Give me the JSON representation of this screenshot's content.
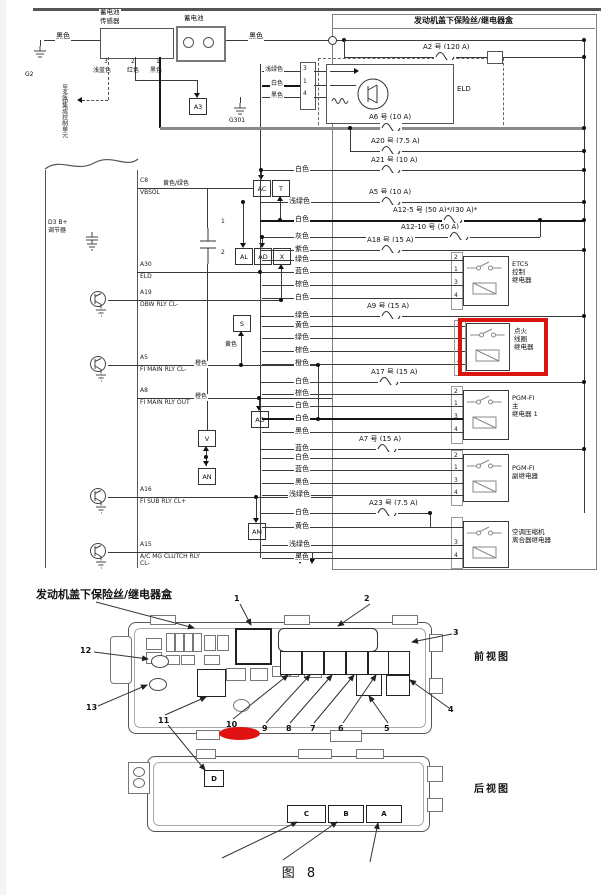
{
  "caption": "图  8",
  "schematic": {
    "box_title": "发动机盖下保险丝/继电器盒",
    "battery_sensor": [
      "蓄电池",
      "传感器"
    ],
    "battery_label": "蓄电池",
    "eld_label": "ELD",
    "regulator": [
      "D3 B+",
      "调节器"
    ],
    "note": "至多路集成控制单元",
    "g2": "G2",
    "g301": "G301",
    "sensor_pins": [
      "3",
      "2",
      "1"
    ],
    "eld_pins": [
      "3",
      "1",
      "4"
    ],
    "cap_pins": [
      "1",
      "2"
    ],
    "connectors": [
      "A3",
      "AC",
      "T",
      "AL",
      "AD",
      "X",
      "S",
      "AO",
      "V",
      "AN",
      "AM"
    ],
    "fuses": {
      "a2": "A2 号 (120 A)",
      "a6": "A6 号 (10 A)",
      "a20": "A20 号 (7.5 A)",
      "a21": "A21 号 (10 A)",
      "a5": "A5 号 (10 A)",
      "a12_5": "A12-5 号 (50 A)*/(30 A)*",
      "a12_10": "A12-10 号 (50 A)",
      "a18": "A18 号 (15 A)",
      "a9": "A9 号 (15 A)",
      "a17": "A17 号 (15 A)",
      "a7": "A7 号 (15 A)",
      "a23": "A23 号 (7.5 A)"
    },
    "relays": {
      "etcs": [
        "ETCS",
        "控制",
        "继电器"
      ],
      "ignition_coil": [
        "点火",
        "线圈",
        "继电器"
      ],
      "pgm_main": [
        "PGM-FI",
        "主",
        "继电器 1"
      ],
      "pgm_sub": [
        "PGM-FI",
        "副继电器"
      ],
      "ac_clutch": [
        "空调压缩机",
        "离合器继电器"
      ]
    },
    "relay_pins": [
      "2",
      "1",
      "3",
      "4"
    ],
    "ecm_pins": [
      {
        "code": "C8",
        "name": "VBSOL"
      },
      {
        "code": "A30",
        "name": "ELD"
      },
      {
        "code": "A19",
        "name": "DBW RLY CL-"
      },
      {
        "code": "A5",
        "name": "FI MAIN RLY CL-"
      },
      {
        "code": "A8",
        "name": "FI MAIN RLY OUT"
      },
      {
        "code": "A16",
        "name": "FI SUB RLY CL+"
      },
      {
        "code": "A15",
        "name": "A/C MG CLUTCH RLY CL-"
      }
    ],
    "wire_colors": {
      "battery_left": "黑色",
      "battery_right": "黑色",
      "sensor": [
        "浅蓝色",
        "红色",
        "黑色"
      ],
      "eld_in": [
        "浅绿色",
        "白色",
        "黑色"
      ],
      "cap_branch": "黄色/绿色",
      "s_branch": "黄色",
      "a5_row": "橙色",
      "a8_row": "橙色",
      "rows": {
        "a21": "白色",
        "a5": "浅绿色",
        "a12_5": "白色",
        "a12_10": "灰色",
        "a18": "紫色",
        "a9": "绿色",
        "a17": "白色",
        "a7": "蓝色",
        "a23": "白色"
      },
      "etcs": [
        "绿色",
        "蓝色",
        "棕色",
        "白色"
      ],
      "ignition": [
        "黄色",
        "绿色",
        "棕色",
        "橙色"
      ],
      "pgm_main": [
        "棕色",
        "白色",
        "白色",
        "黑色"
      ],
      "pgm_sub": [
        "白色",
        "蓝色",
        "黑色",
        "浅绿色"
      ],
      "ac": [
        "黄色",
        "浅绿色",
        "黑色"
      ]
    }
  },
  "fusebox": {
    "title": "发动机盖下保险丝/继电器盒",
    "front_label": "前视图",
    "rear_label": "后视图",
    "callouts": [
      "1",
      "2",
      "3",
      "4",
      "5",
      "6",
      "7",
      "8",
      "9",
      "10",
      "11",
      "12",
      "13"
    ],
    "slots": [
      "A",
      "B",
      "C",
      "D"
    ]
  },
  "colors": {
    "highlight": "#d9150f"
  }
}
